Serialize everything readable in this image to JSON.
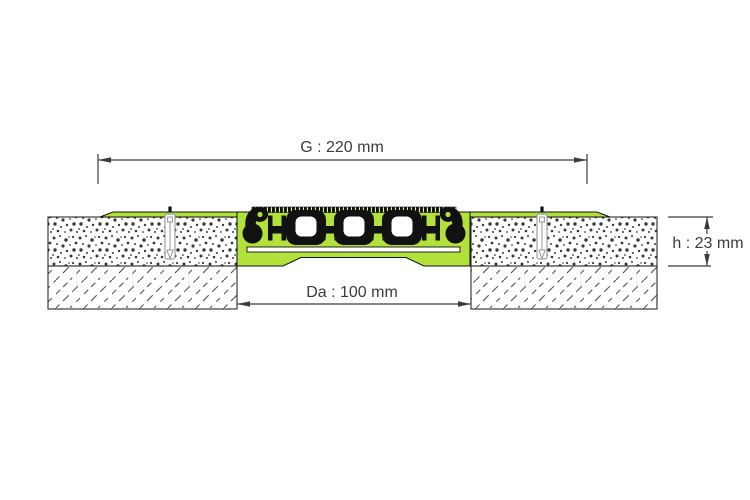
{
  "dimensions": {
    "width_label": "G : 220 mm",
    "gap_label": "Da : 100 mm",
    "height_label": "h : 23 mm"
  },
  "colors": {
    "profile_green": "#b3e13c",
    "outline": "#111111",
    "dimension": "#3c3c3c",
    "speckle": "#3a3a3a",
    "hatch": "#555555",
    "background": "#ffffff"
  }
}
